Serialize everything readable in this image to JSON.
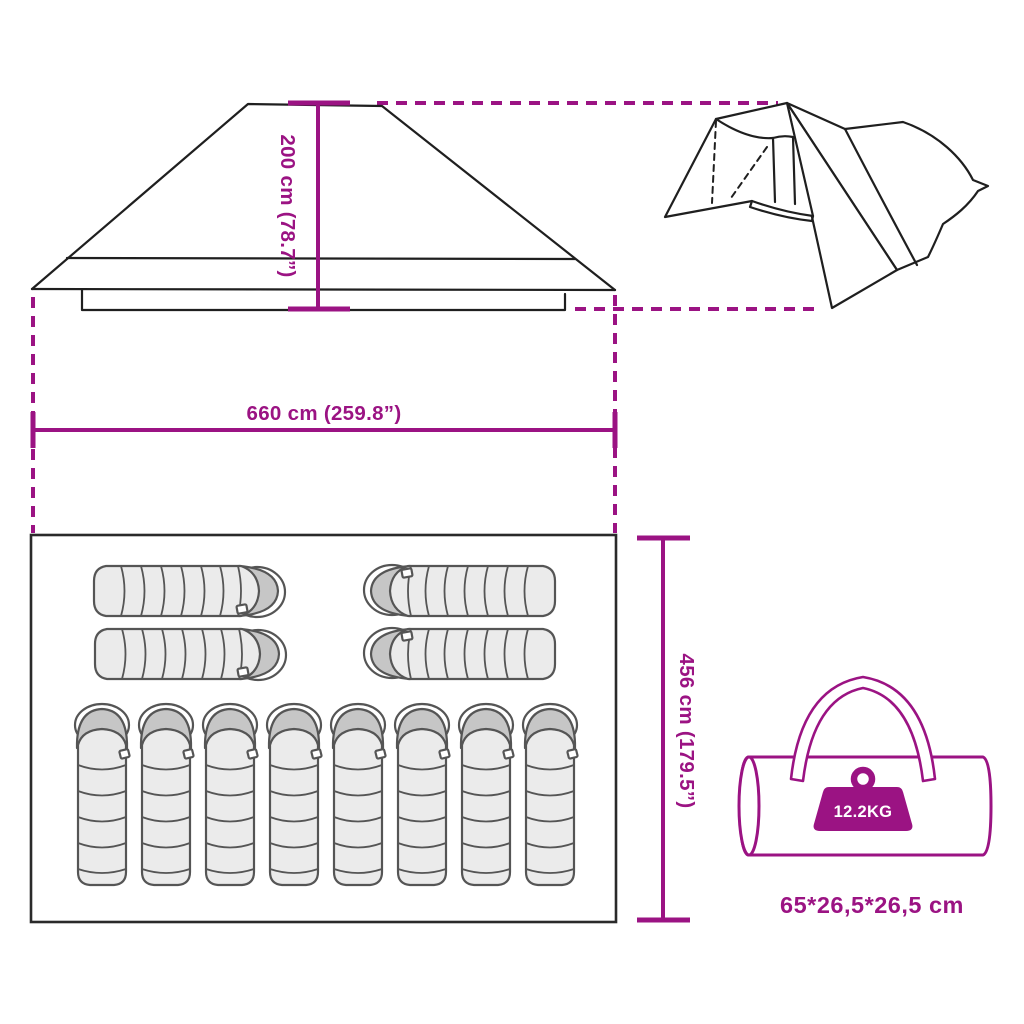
{
  "colors": {
    "accent": "#9b1383",
    "ink": "#1f1f1f",
    "floor-ink": "#2a2a2a",
    "bag-fill": "#ebebeb",
    "bag-hood": "#c6c6c6",
    "bag-ink": "#555555",
    "background": "#ffffff"
  },
  "labels": {
    "height": "200 cm (78.7”)",
    "width": "660 cm (259.8”)",
    "depth": "456 cm (179.5”)",
    "weight": "12.2KG",
    "packed_size": "65*26,5*26,5 cm"
  },
  "figures": {
    "floorplan": {
      "sleeping_bags_horizontal": 4,
      "sleeping_bags_vertical": 8
    },
    "icons": [
      "weight-icon",
      "carry-bag-icon",
      "tent-3d-icon",
      "tent-roof-icon"
    ]
  }
}
